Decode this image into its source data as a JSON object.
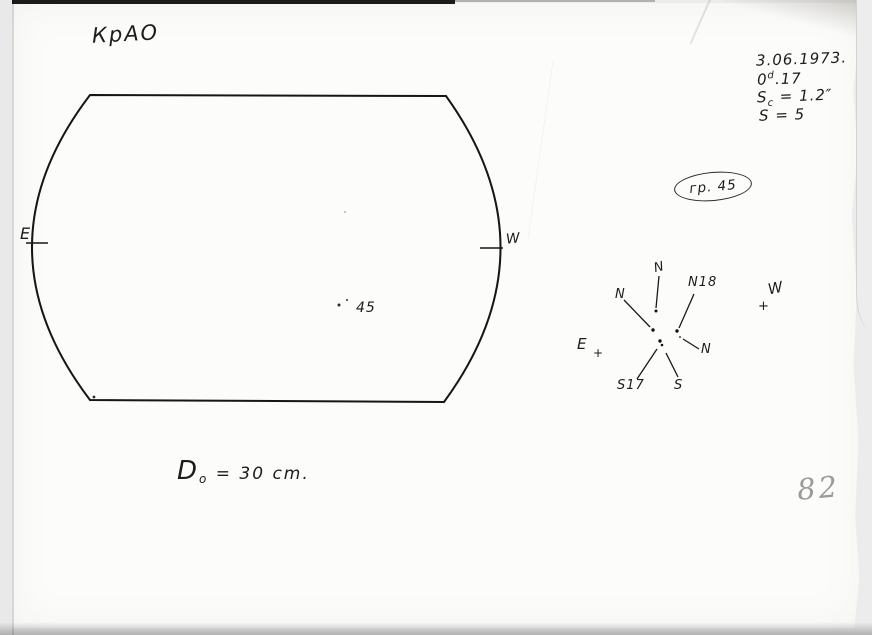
{
  "page": {
    "observatory_label": "КрАО",
    "page_number": "82"
  },
  "header": {
    "date": "3.06.1973.",
    "time_base": "0",
    "time_sup": "d",
    "time_rest": ".17",
    "sc_base": "S",
    "sc_sub": "c",
    "sc_rest": " = 1.2″",
    "s_line": "S = 5"
  },
  "group_badge": {
    "label": "гр. 45"
  },
  "disk": {
    "east_label": "E",
    "west_label": "W",
    "spot_group_label": "45"
  },
  "footer_note": {
    "d_base": "D",
    "d_sub": "o",
    "d_rest": " = 30 cm."
  },
  "star_chart": {
    "n_top": "N",
    "n_left": "N",
    "n18": "N18",
    "n_right": "N",
    "s17": "S17",
    "s": "S",
    "east": "E",
    "west": "W",
    "plus_east": "+",
    "plus_west": "+"
  },
  "ink_color": "#1a1a1a",
  "pencil_color": "#9b9b9b"
}
